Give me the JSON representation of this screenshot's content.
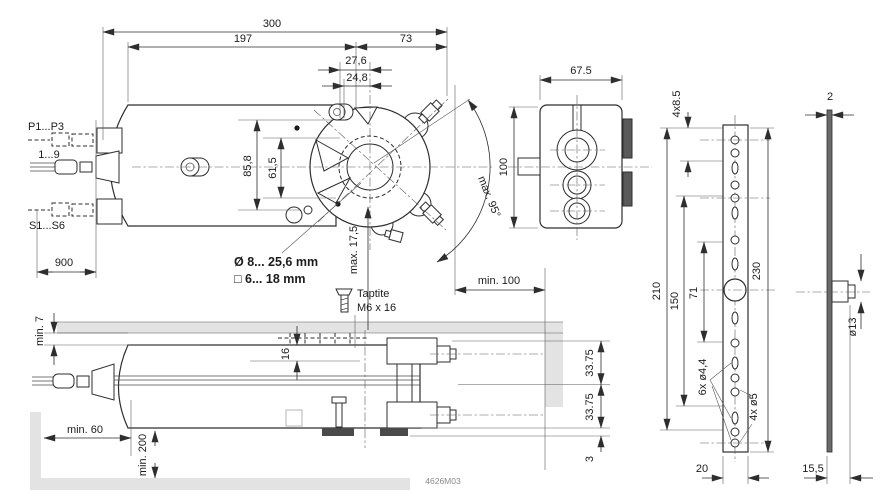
{
  "doc": {
    "number": "4626M03"
  },
  "colors": {
    "line": "#2e2e2e",
    "shade": "#e3e3e3",
    "dark_fill": "#555555"
  },
  "top_view": {
    "d300": "300",
    "d197": "197",
    "d73": "73",
    "d276": "27,6",
    "d248": "24,8",
    "d858": "85,8",
    "d615": "61,5",
    "dmax175": "max. 17,5",
    "dmax95": "max. 95°",
    "dmin100": "min. 100",
    "d900": "900",
    "lbl_p": "P1...P3",
    "lbl_19": "1...9",
    "lbl_s": "S1...S6",
    "shaft_round": "Ø 8... 25,6 mm",
    "shaft_square": "□ 6... 18 mm"
  },
  "end_view": {
    "d675": "67.5",
    "d100": "100"
  },
  "bracket_view": {
    "d4x85": "4x8.5",
    "d210": "210",
    "d150": "150",
    "d71": "71",
    "d230": "230",
    "d6x44": "6x ø4,4",
    "d4x5": "4x ø5",
    "d20": "20"
  },
  "plate_view": {
    "d2": "2",
    "d13": "ø13",
    "d155": "15,5"
  },
  "mount_view": {
    "dmin7": "min. 7",
    "d16": "16",
    "screw_line1": "Taptite",
    "screw_line2": "M6 x 16",
    "d3375_top": "33.75",
    "d3375_bottom": "33.75",
    "d3": "3",
    "dmin60": "min. 60",
    "dmin200": "min. 200"
  }
}
